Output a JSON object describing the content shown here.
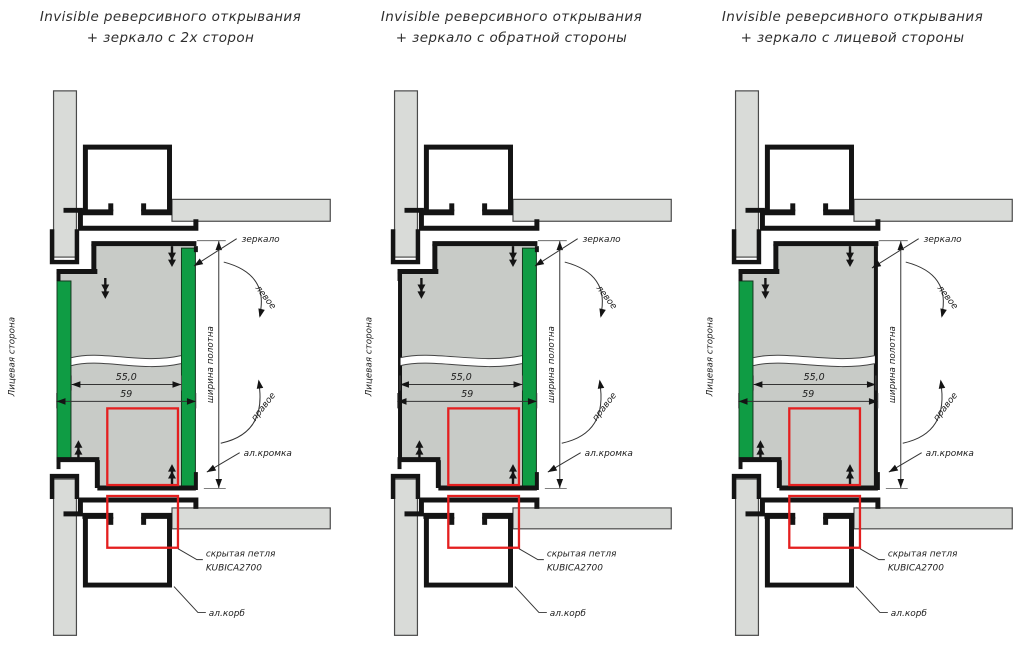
{
  "panels": [
    {
      "id": "mirror-both-sides",
      "title_line1": "Invisible реверсивного открывания",
      "title_line2": "+ зеркало с 2х сторон",
      "mirror_sides": "front and back"
    },
    {
      "id": "mirror-back-side",
      "title_line1": "Invisible реверсивного открывания",
      "title_line2": "+ зеркало с обратной стороны",
      "mirror_sides": "back"
    },
    {
      "id": "mirror-front-side",
      "title_line1": "Invisible реверсивного открывания",
      "title_line2": "+ зеркало с лицевой стороны",
      "mirror_sides": "front"
    }
  ],
  "labels": {
    "mirror": "зеркало",
    "swing_left": "левое",
    "swing_right": "правое",
    "alu_edge": "ал.кромка",
    "hidden_hinge_line1": "скрытая петля",
    "hidden_hinge_line2": "KUBICA2700",
    "alu_box": "ал.корб",
    "front_side": "Лицевая сторона",
    "leaf_width": "ширина полотна"
  },
  "dimensions": {
    "inner_width": "55,0",
    "outer_width": "59"
  },
  "colors": {
    "mirror_green": "#0f9c44",
    "hinge_marker_red": "#e41f1f",
    "wall_gray": "#d9dbd8",
    "leaf_gray": "#c8cbc7",
    "line_black": "#141414"
  }
}
